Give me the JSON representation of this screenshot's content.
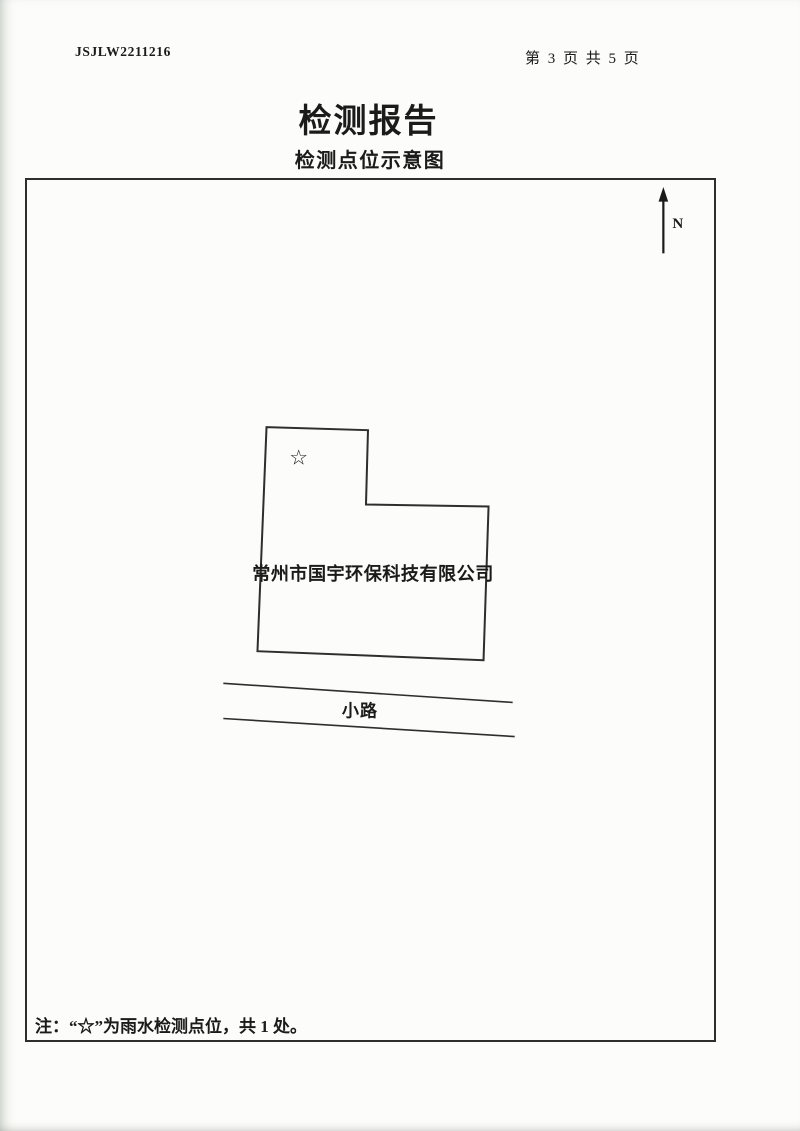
{
  "header": {
    "report_no": "JSJLW2211216",
    "page_indicator": "第 3 页 共 5 页"
  },
  "title": "检测报告",
  "subtitle": "检测点位示意图",
  "diagram": {
    "north_label": "N",
    "building": {
      "name": "常州市国宇环保科技有限公司"
    },
    "sampling_point": {
      "symbol": "☆"
    },
    "road_label": "小路",
    "note": "注：“☆”为雨水检测点位，共 1 处。"
  },
  "colors": {
    "paper": "#fcfcfa",
    "ink": "#1b1b1b",
    "line": "#2e2e2e"
  }
}
